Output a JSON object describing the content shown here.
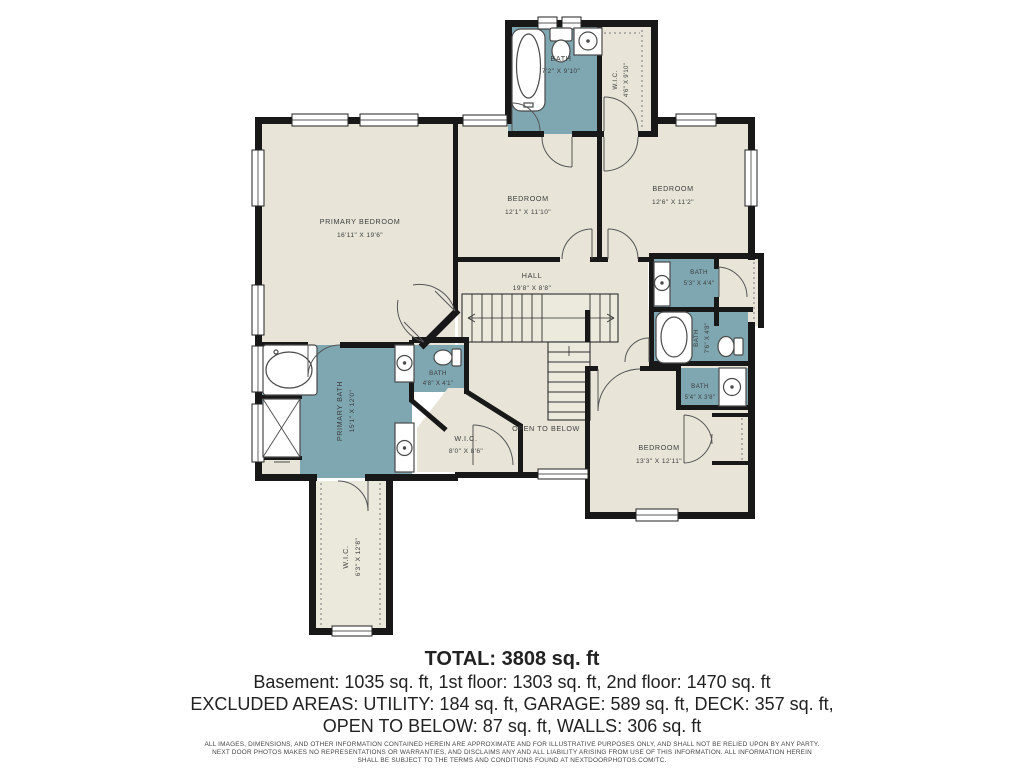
{
  "plan": {
    "rooms": {
      "top_bath": {
        "name": "BATH",
        "dims": "7'2\" X 9'10\""
      },
      "top_wic": {
        "name": "W.I.C.",
        "dims": "4'6\" X 9'10\""
      },
      "primary_bedroom": {
        "name": "PRIMARY BEDROOM",
        "dims": "16'11\" X 19'6\""
      },
      "bedroom_mid": {
        "name": "BEDROOM",
        "dims": "12'1\" X 11'10\""
      },
      "bedroom_right": {
        "name": "BEDROOM",
        "dims": "12'6\" X 11'2\""
      },
      "hall": {
        "name": "HALL",
        "dims": "19'8\" X 8'8\""
      },
      "bath_a": {
        "name": "BATH",
        "dims": "5'3\" X 4'4\""
      },
      "bath_b": {
        "name": "BATH",
        "dims": "7'6\" X 4'8\""
      },
      "bath_c": {
        "name": "BATH",
        "dims": "5'4\" X 3'8\""
      },
      "primary_bath": {
        "name": "PRIMARY BATH",
        "dims": "15'1\" X 12'0\""
      },
      "water_closet": {
        "name": "BATH",
        "dims": "4'8\" X 4'1\""
      },
      "wic_mid": {
        "name": "W.I.C.",
        "dims": "8'0\" X 8'6\""
      },
      "open_below": {
        "name": "OPEN TO BELOW"
      },
      "bedroom_bottom": {
        "name": "BEDROOM",
        "dims": "13'3\" X 12'11\""
      },
      "wic_bottom": {
        "name": "W.I.C.",
        "dims": "6'3\" X 12'8\""
      }
    },
    "colors": {
      "bath_fill": "#7ea7b1",
      "room_fill": "#e8e5d8",
      "wall": "#181818"
    }
  },
  "summary": {
    "total": "TOTAL: 3808 sq. ft",
    "floors": "Basement: 1035 sq. ft, 1st floor: 1303 sq. ft, 2nd floor: 1470 sq. ft",
    "excluded1": "EXCLUDED AREAS: UTILITY: 184 sq. ft, GARAGE: 589 sq. ft, DECK: 357 sq. ft,",
    "excluded2": "OPEN TO BELOW: 87 sq. ft, WALLS: 306 sq. ft",
    "disclaimer1": "ALL IMAGES, DIMENSIONS, AND OTHER INFORMATION CONTAINED HEREIN ARE APPROXIMATE AND FOR ILLUSTRATIVE PURPOSES ONLY, AND SHALL NOT BE RELIED UPON BY ANY PARTY.",
    "disclaimer2": "NEXT DOOR PHOTOS MAKES NO REPRESENTATIONS OR WARRANTIES, AND DISCLAIMS ANY AND ALL LIABILITY ARISING FROM USE OF THIS INFORMATION. ALL INFORMATION HEREIN",
    "disclaimer3": "SHALL BE SUBJECT TO THE TERMS AND CONDITIONS FOUND AT NEXTDOORPHOTOS.COM/TC."
  }
}
